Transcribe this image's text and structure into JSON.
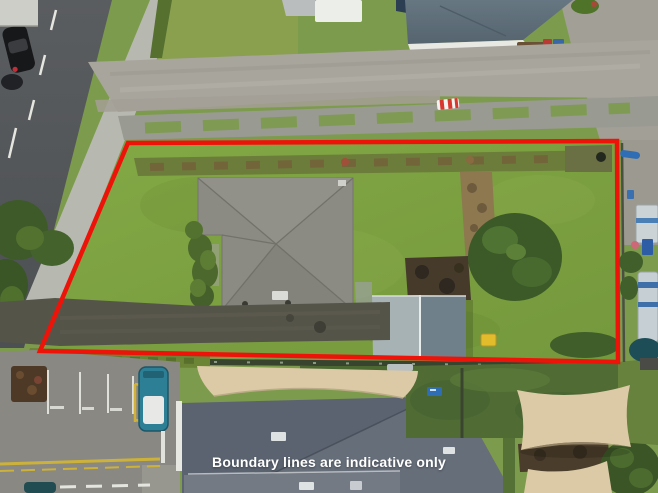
{
  "photo": {
    "kind": "aerial-drone-photograph-of-residential-property",
    "caption": "Boundary lines are indicative only"
  },
  "boundary": {
    "color": "#ee1309",
    "stroke_width": "4.5"
  },
  "palette": {
    "lawn": "#82a746",
    "road": "#55585b",
    "gravel": "#a8a59d",
    "house_roof": "#8b8b84",
    "shed_roof_light": "#a7b2b4",
    "shed_roof_dark": "#70808a",
    "building_roof": "#5b6370",
    "shade_sail": "#dccaa6",
    "van": "#2d7f96",
    "caption_text": "#ffffff"
  }
}
